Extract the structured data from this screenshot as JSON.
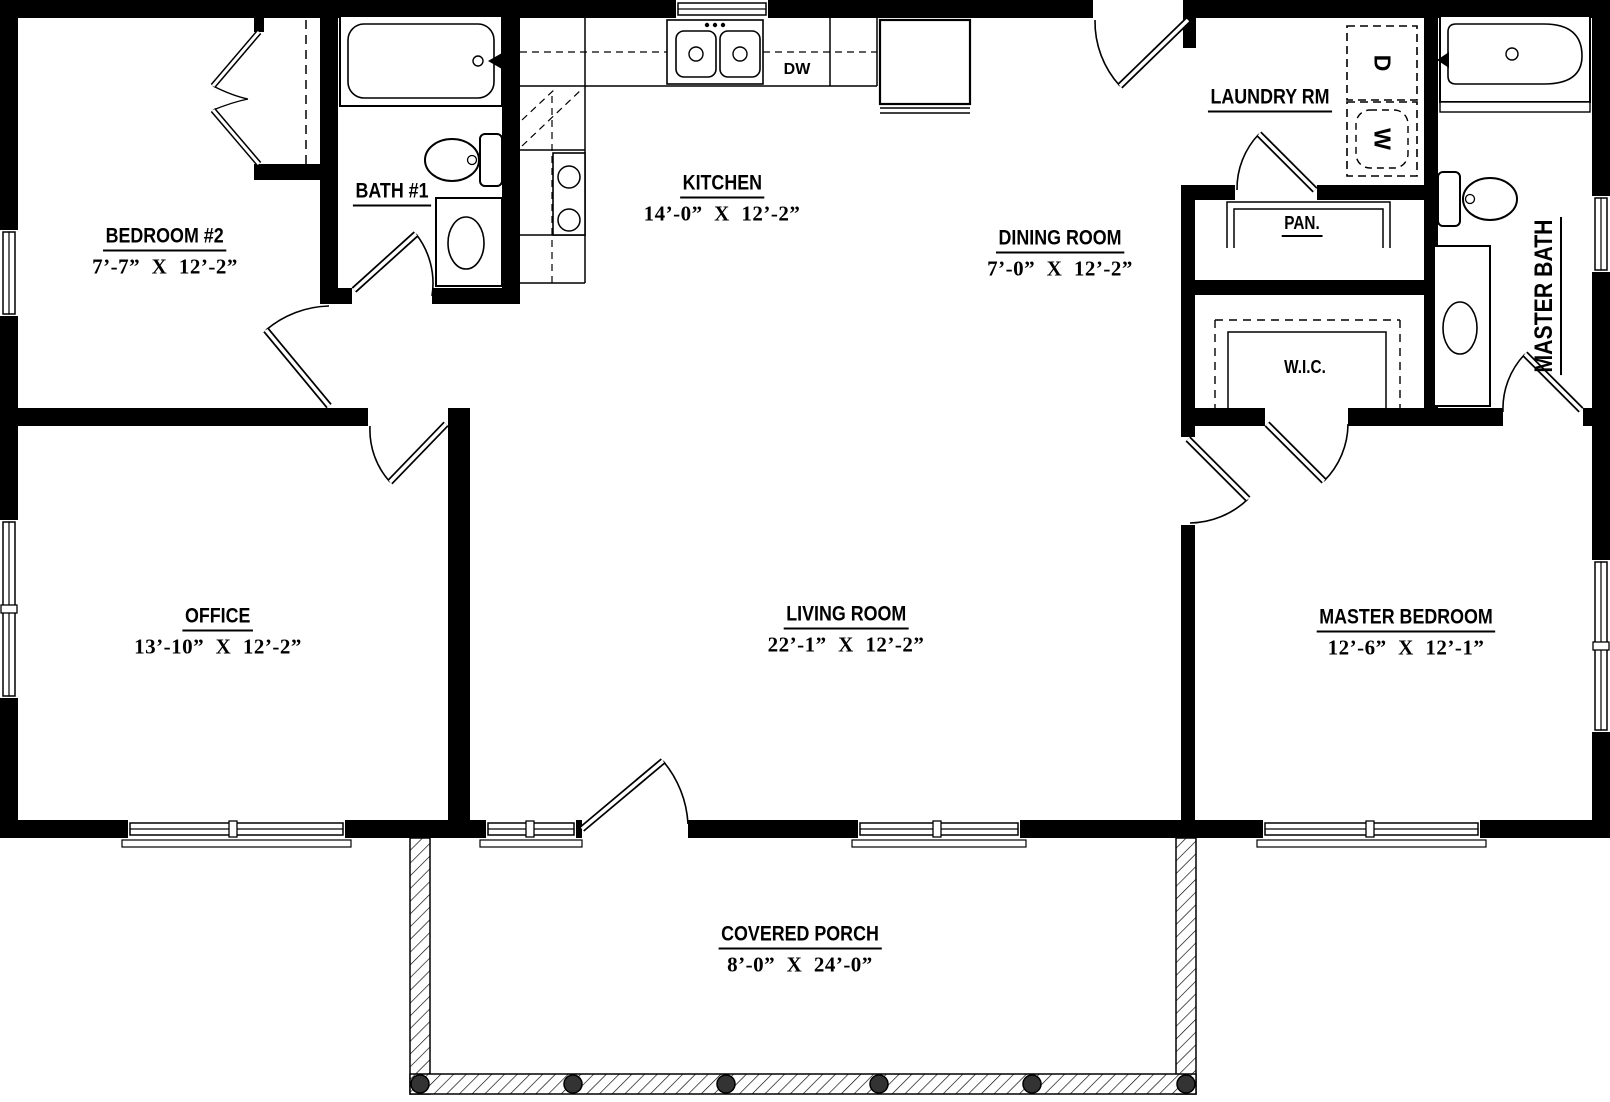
{
  "plan": {
    "colors": {
      "wall": "#000000",
      "background": "#ffffff",
      "post": "#333333"
    },
    "rooms": [
      {
        "name": "BEDROOM #2",
        "dims": "7’-7”  X  12’-2”"
      },
      {
        "name": "BATH #1",
        "dims": ""
      },
      {
        "name": "KITCHEN",
        "dims": "14’-0”  X  12’-2”"
      },
      {
        "name": "DINING ROOM",
        "dims": "7’-0”  X  12’-2”"
      },
      {
        "name": "LAUNDRY RM",
        "dims": ""
      },
      {
        "name": "PAN.",
        "dims": ""
      },
      {
        "name": "W.I.C.",
        "dims": ""
      },
      {
        "name": "MASTER BATH",
        "dims": ""
      },
      {
        "name": "OFFICE",
        "dims": "13’-10”  X  12’-2”"
      },
      {
        "name": "LIVING ROOM",
        "dims": "22’-1”  X  12’-2”"
      },
      {
        "name": "MASTER BEDROOM",
        "dims": "12’-6”  X  12’-1”"
      },
      {
        "name": "COVERED PORCH",
        "dims": "8’-0”  X  24’-0”"
      }
    ],
    "appliances": {
      "dishwasher": "DW",
      "dryer": "D",
      "washer": "W"
    }
  }
}
